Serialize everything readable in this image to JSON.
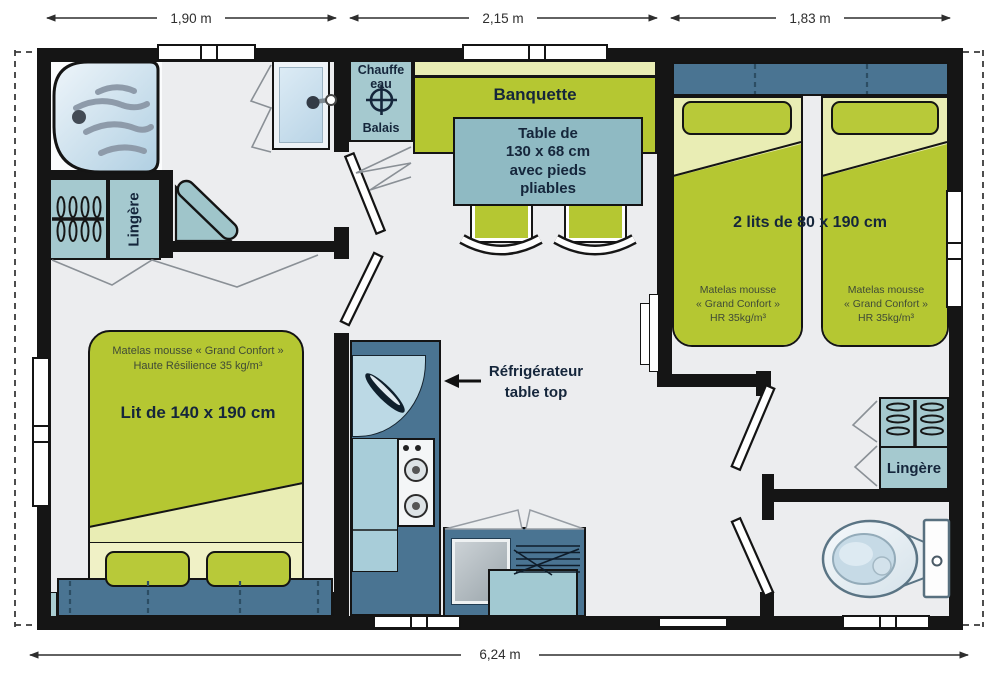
{
  "dimensions": {
    "w1": "1,90 m",
    "w2": "2,15 m",
    "w3": "1,83 m",
    "total": "6,24 m"
  },
  "bathroom": {
    "linen": "Lingère",
    "heater_l1": "Chauffe",
    "heater_l2": "eau",
    "broom": "Balais"
  },
  "living": {
    "bench": "Banquette",
    "table_l1": "Table de",
    "table_l2": "130 x 68 cm",
    "table_l3": "avec pieds",
    "table_l4": "pliables",
    "fridge_l1": "Réfrigérateur",
    "fridge_l2": "table top"
  },
  "twin_bedroom": {
    "title": "2 lits de 80 x 190 cm",
    "mattress_l1": "Matelas mousse",
    "mattress_l2": "« Grand Confort »",
    "mattress_l3": "HR 35kg/m³",
    "linen": "Lingère"
  },
  "master_bedroom": {
    "title": "Lit de 140 x 190 cm",
    "mattress_l1": "Matelas mousse « Grand Confort »",
    "mattress_l2": "Haute Résilience 35 kg/m³"
  },
  "colors": {
    "wall": "#151515",
    "floor": "#ecedef",
    "green": "#b5c732",
    "green_pale": "#e9edb4",
    "steel_blue": "#4a7492",
    "teal_closet": "#a5c9cf",
    "table_teal": "#8fbac3",
    "light_blue": "#b6d6e2",
    "text": "#15263b"
  }
}
